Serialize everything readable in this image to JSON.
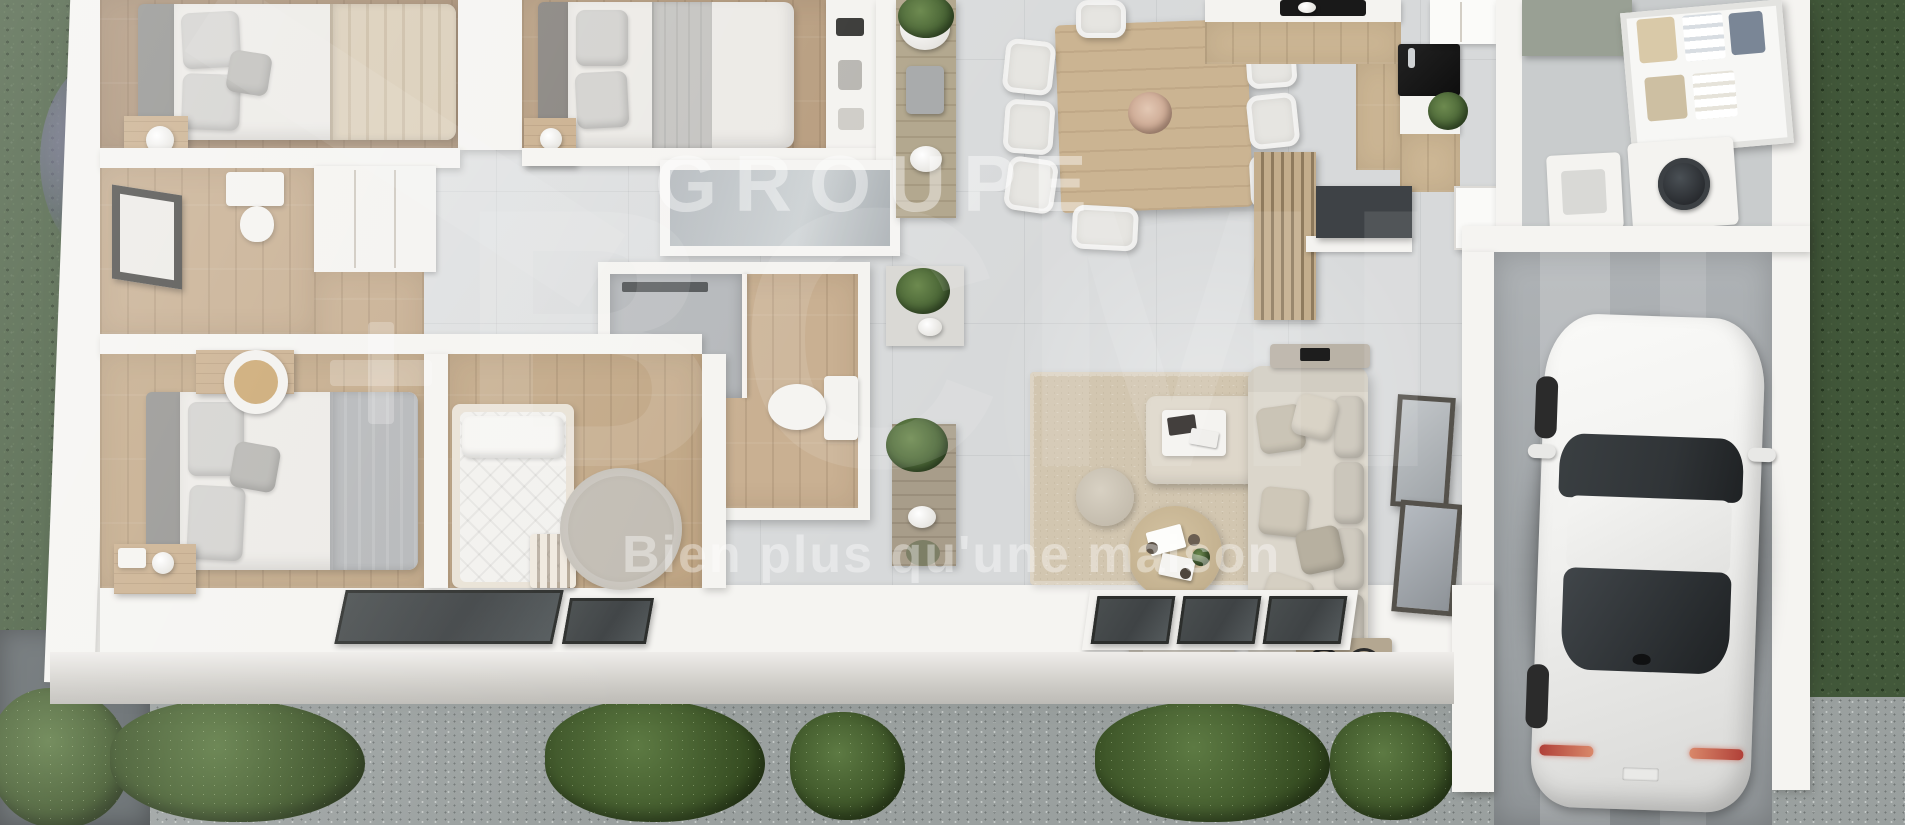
{
  "watermark": {
    "groupe": "GROUPE",
    "brand": "BCMI",
    "tagline": "Bien plus qu'une maison"
  },
  "colors": {
    "grass": "#42583a",
    "gravel": "#9aa09f",
    "terrace": "#5e6568",
    "wall": "#f5f4f1",
    "tile": "#d7d9da",
    "tile_dark": "#c9cccd",
    "wood": "#b89e80",
    "wood_dark": "#ab9176",
    "wood_light": "#cbb492",
    "shower": "#b6b9bc",
    "glass_dark": "#3f4345",
    "frame_dark": "#4b4a47",
    "sofa": "#dbd6cb",
    "rug": "#d2c6b0",
    "car_body": "#f0f0ee",
    "car_glass": "#303437",
    "plant": "#3f5a2e",
    "slat_wood": "#c3ad8c",
    "sage": "#99a094",
    "taillight": "#b04038"
  }
}
